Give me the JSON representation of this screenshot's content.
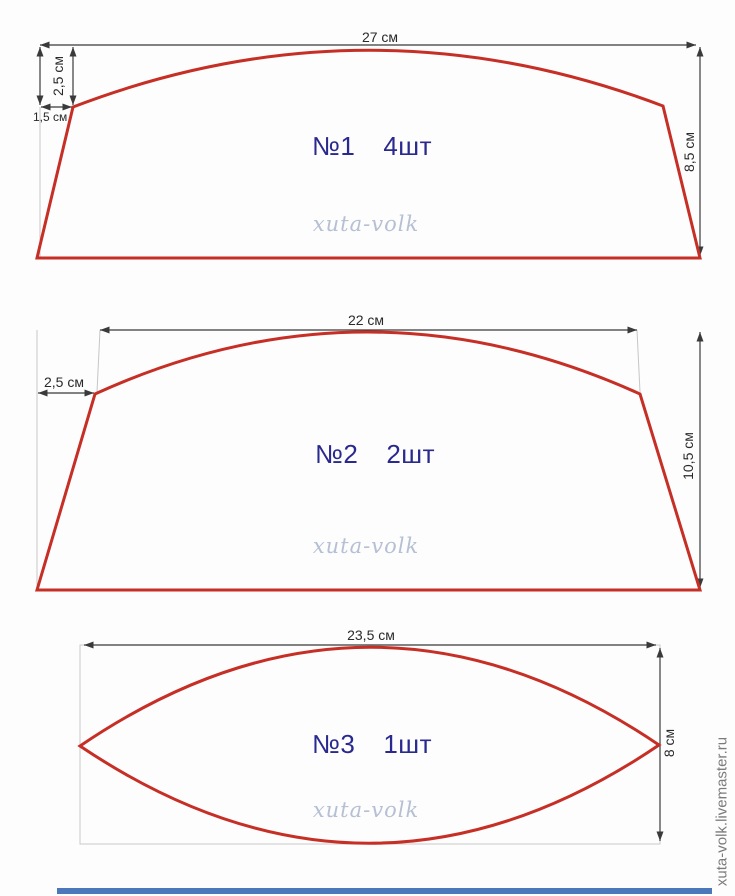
{
  "colors": {
    "outline": "#c62f26",
    "label": "#29298f",
    "dim": "#3a3a3a",
    "watermark": "#b6c0d4",
    "site": "#7b7b7b",
    "footer": "#4a78bb",
    "background": "#fdfdfd"
  },
  "site_credit": "xuta-volk.livemaster.ru",
  "pieces": [
    {
      "number": "№1",
      "quantity": "4шт",
      "watermark": "xuta-volk",
      "dims": {
        "top_width": "27 см",
        "side_height": "8,5 см",
        "notch_height": "2,5 см",
        "notch_width": "1,5 см"
      }
    },
    {
      "number": "№2",
      "quantity": "2шт",
      "watermark": "xuta-volk",
      "dims": {
        "top_width": "22 см",
        "side_height": "10,5 см",
        "notch_width": "2,5 см"
      }
    },
    {
      "number": "№3",
      "quantity": "1шт",
      "watermark": "xuta-volk",
      "dims": {
        "width": "23,5 см",
        "height": "8 см"
      }
    }
  ]
}
